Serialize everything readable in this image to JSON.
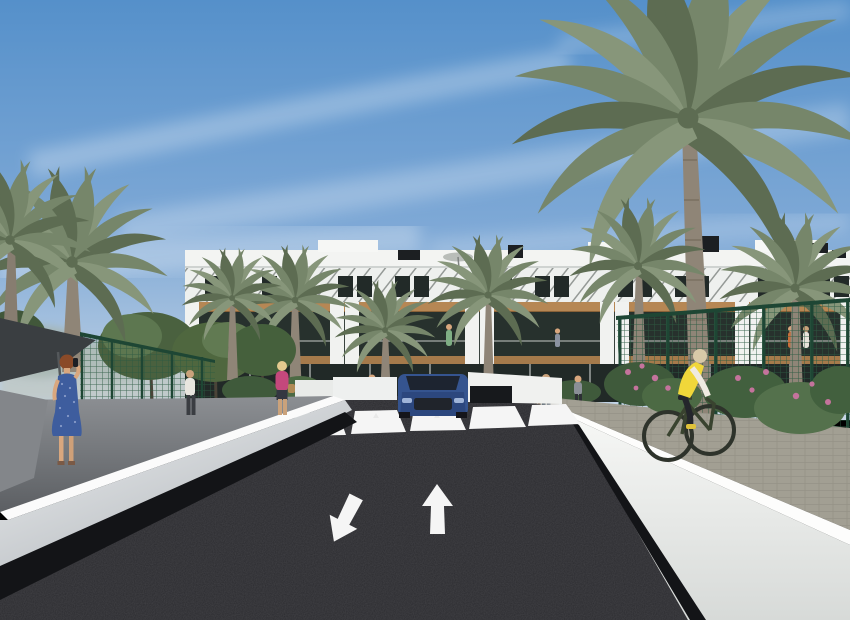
{
  "scene": {
    "description": "Architectural 3D rendering of a modern white apartment complex with wood-clad balconies, tall palm trees, a dark asphalt access road with zebra crossing and two lane arrows, a blue car at a garage ramp, a woman in a blue dress on the left sidewalk, a cyclist with a yellow vest on the right path, and pedestrians on the promenade.",
    "objects": [
      "sky with wispy clouds",
      "apartment building",
      "roof umbrella",
      "palm trees",
      "deciduous trees",
      "green mesh fence",
      "shade canopy",
      "asphalt road",
      "zebra crosswalk",
      "lane arrows",
      "blue car",
      "garage ramp",
      "white retaining walls",
      "left shaded sidewalk",
      "right tiled path",
      "woman in blue dress",
      "man in white shirt",
      "woman in pink top",
      "pedestrian group",
      "cyclist in yellow vest",
      "pink flowering shrubs",
      "white planters"
    ]
  },
  "colors": {
    "sky_top": "#5590ca",
    "sky_mid": "#7fa9d6",
    "sky_horizon": "#c8d7e7",
    "cloud": "#ffffff",
    "building_white": "#f3f4f2",
    "wood": "#b68754",
    "glass_dark": "#27312d",
    "ground_glass": "#212927",
    "louver": "#4b524e",
    "palm_green": "#76866a",
    "palm_green_dark": "#5d6c52",
    "palm_green_light": "#87967a",
    "palm_trunk": "#8f8577",
    "tree_green": "#4a613f",
    "tree_green_light": "#5d7750",
    "fence_green": "#2c5a42",
    "canopy_dark": "#3a3e41",
    "road": "#2b2b2f",
    "road_marking": "#f5f5f5",
    "wall_light": "#f2f3f1",
    "wall_shade": "#b9bdc2",
    "wall_base_dark": "#131417",
    "path_shade": "#6b6e72",
    "path_tiles": "#a29f93",
    "planter_white": "#e9ebe9",
    "shrub": "#3f5a3b",
    "flower_pink": "#c4739c",
    "car_blue": "#35548f",
    "car_blue_dark": "#22386b",
    "dress_blue": "#3e5d9e",
    "hair_red": "#8a4a28",
    "skin": "#d9a77e",
    "vest_yellow": "#f0d73a",
    "sleeve_white": "#efeae0",
    "pants_dark": "#24262b",
    "bike_frame": "#39432f",
    "pink_top": "#c4487c",
    "shirt_white": "#e8e6df"
  }
}
